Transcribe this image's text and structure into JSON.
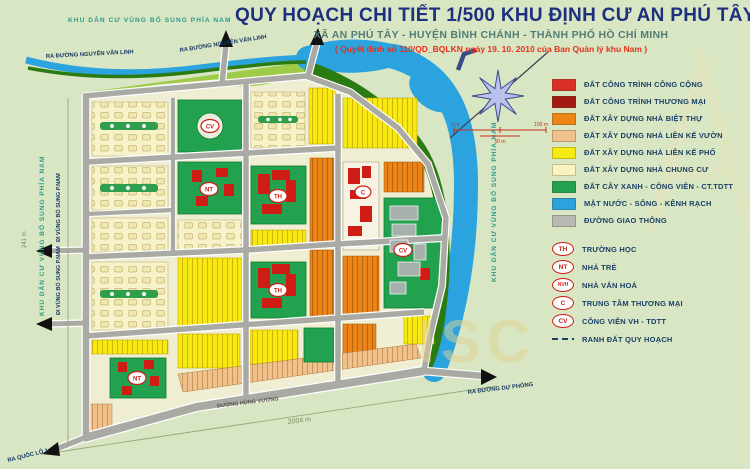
{
  "header": {
    "area_label": "KHU DÂN CƯ VÙNG BỔ SUNG PHÍA NAM",
    "title": "QUY HOẠCH CHI TIẾT 1/500 KHU ĐỊNH CƯ AN PHÚ TÂY",
    "subtitle": "XÃ AN PHÚ TÂY - HUYỆN BÌNH CHÁNH - THÀNH PHỐ HỒ CHÍ MINH",
    "decision": "( Quyết định số 110/QD_BQLKN ngày 19. 10. 2010 của Ban Quản lý khu Nam )"
  },
  "legend": {
    "items": [
      {
        "color": "#d93025",
        "label": "ĐẤT CÔNG TRÌNH CÔNG CỘNG"
      },
      {
        "color": "#a31a15",
        "label": "ĐẤT CÔNG TRÌNH THƯƠNG MẠI"
      },
      {
        "color": "#ec8418",
        "label": "ĐẤT XÂY DỰNG NHÀ BIỆT THỰ"
      },
      {
        "color": "#efc28d",
        "label": "ĐẤT XÂY DỰNG NHÀ LIÊN KẾ VƯỜN"
      },
      {
        "color": "#f6ea12",
        "label": "ĐẤT XÂY DỰNG NHÀ LIÊN KẾ PHỐ"
      },
      {
        "color": "#f9f3c2",
        "label": "ĐẤT XÂY DỰNG NHÀ CHUNG CƯ"
      },
      {
        "color": "#22a24e",
        "label": "ĐẤT CÂY XANH - CÔNG VIÊN - CT.TDTT"
      },
      {
        "color": "#2aa3df",
        "label": "MẶT NƯỚC - SÔNG - KÊNH RẠCH"
      },
      {
        "color": "#b9bab4",
        "label": "ĐƯỜNG GIAO THÔNG"
      }
    ],
    "symbols": [
      {
        "badge": "TH",
        "label": "TRƯỜNG HỌC"
      },
      {
        "badge": "NT",
        "label": "NHÀ TRẺ"
      },
      {
        "badge": "NVH",
        "label": "NHÀ VĂN HOÁ"
      },
      {
        "badge": "C",
        "label": "TRUNG TÂM THƯƠNG MẠI"
      },
      {
        "badge": "CV",
        "label": "CÔNG VIÊN VH - TDTT"
      }
    ],
    "boundary_label": "RANH ĐẤT QUY HOẠCH"
  },
  "map": {
    "side_label": "KHU DÂN CƯ VÙNG BỔ SUNG PHÍA NAM",
    "exits": {
      "nguyen_van_linh": "RA ĐƯỜNG NGUYỄN VĂN LINH",
      "quoc_lo_1": "RA QUỐC LỘ 1",
      "du_phong": "RA ĐƯỜNG DỰ PHÒNG",
      "vung_bo_sung": "ĐI VÙNG BỔ SUNG P.NAM"
    },
    "roads": {
      "hung_vuong": "ĐƯỜNG HÙNG VƯƠNG"
    },
    "dimensions": {
      "south": "2004 m",
      "west": "241 m"
    },
    "scale": {
      "start": "0 m",
      "mid": "50 m",
      "end": "100 m"
    },
    "markers": {
      "school": "TH",
      "kindergarten": "NT",
      "park": "CV",
      "commerce": "C"
    },
    "watermark": "ISC"
  }
}
